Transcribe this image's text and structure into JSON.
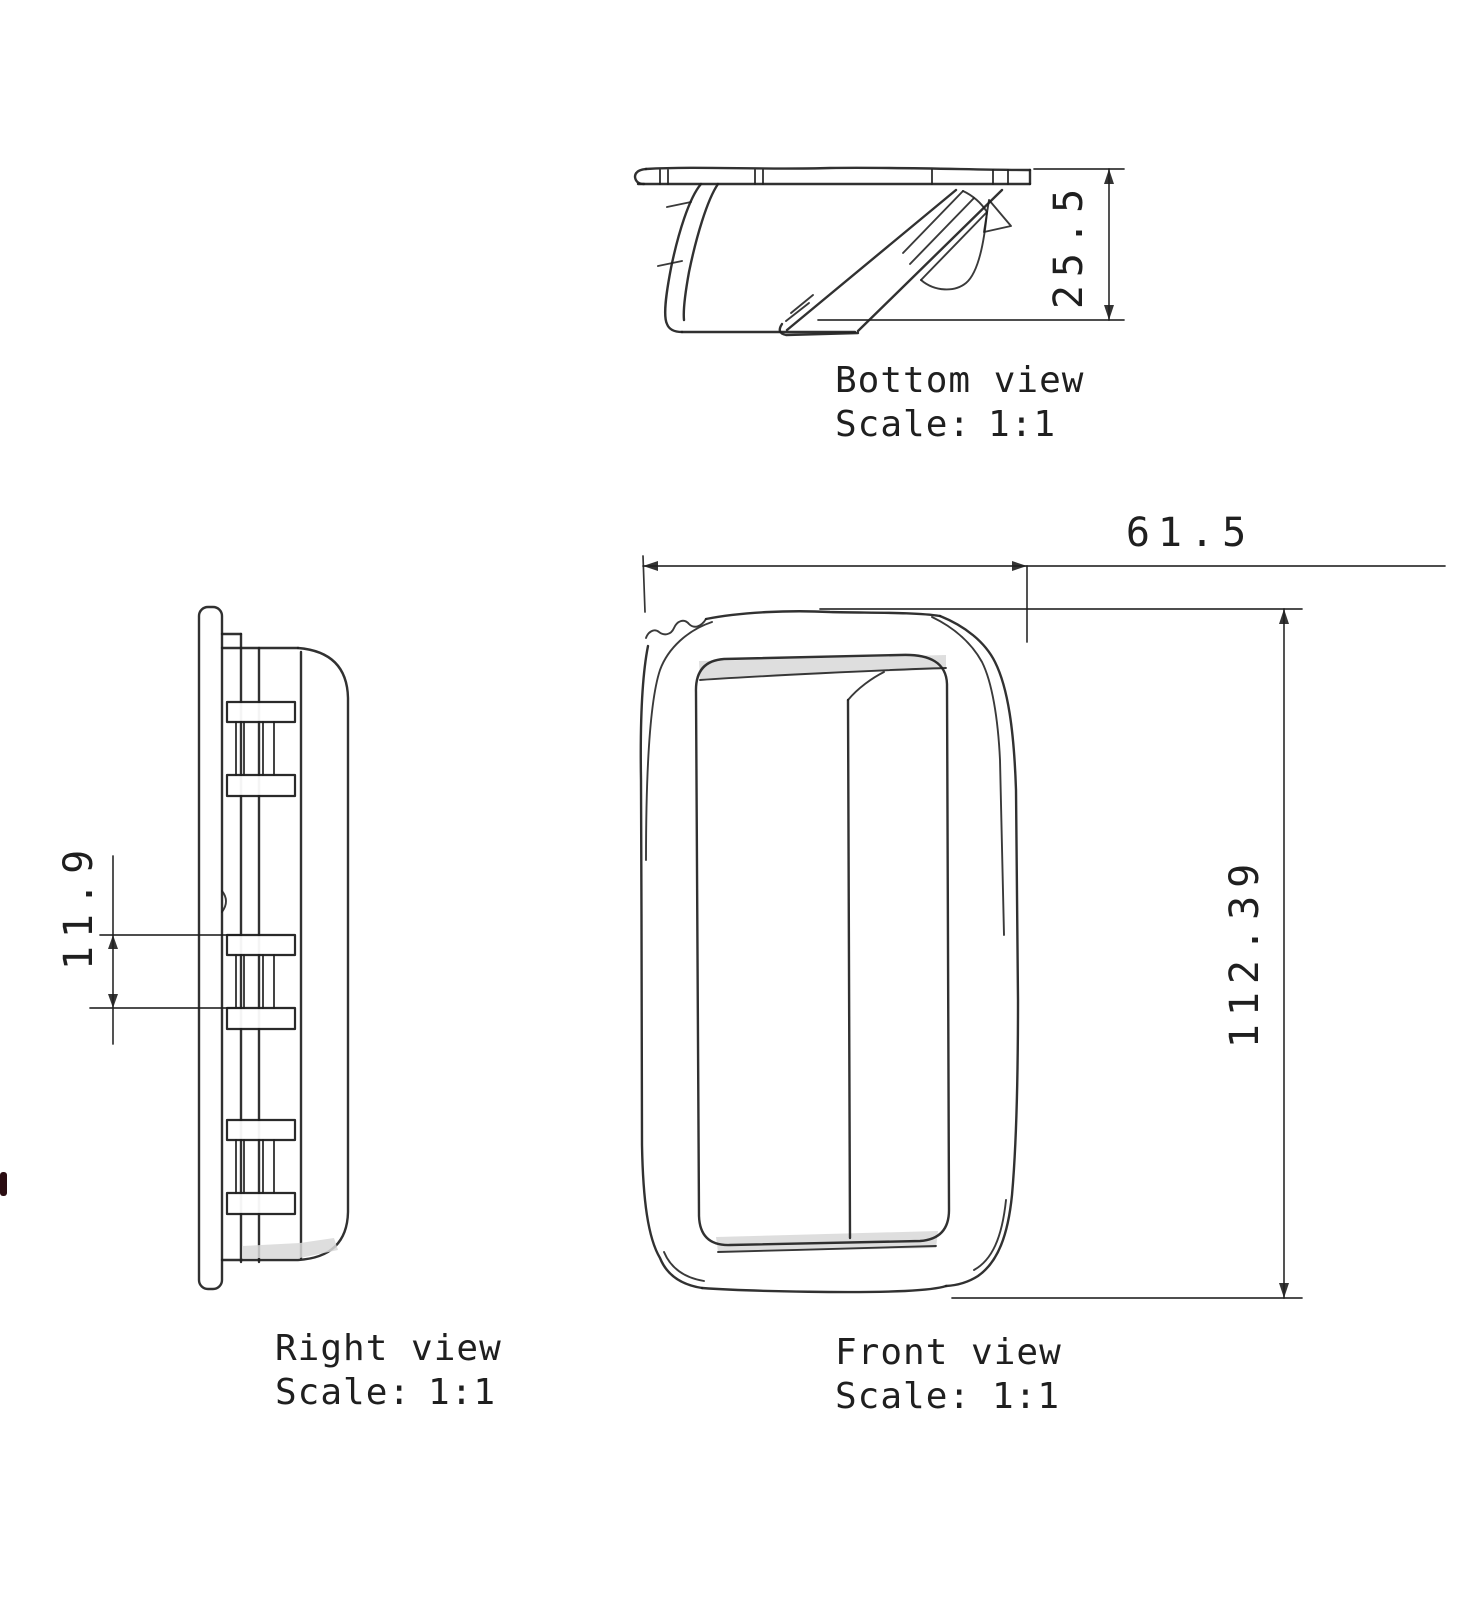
{
  "document_type": "technical-drawing",
  "views": {
    "bottom": {
      "title": "Bottom view",
      "scale_label": "Scale:",
      "scale_value": "1:1",
      "dim_depth": "25.5"
    },
    "right": {
      "title": "Right view",
      "scale_label": "Scale:",
      "scale_value": "1:1",
      "dim_pitch": "11.9"
    },
    "front": {
      "title": "Front view",
      "scale_label": "Scale:",
      "scale_value": "1:1",
      "dim_width": "61.5",
      "dim_height": "112.39"
    }
  },
  "colors": {
    "line": "#1f1f1f",
    "shade": "#d8d8d8",
    "background": "#ffffff"
  }
}
